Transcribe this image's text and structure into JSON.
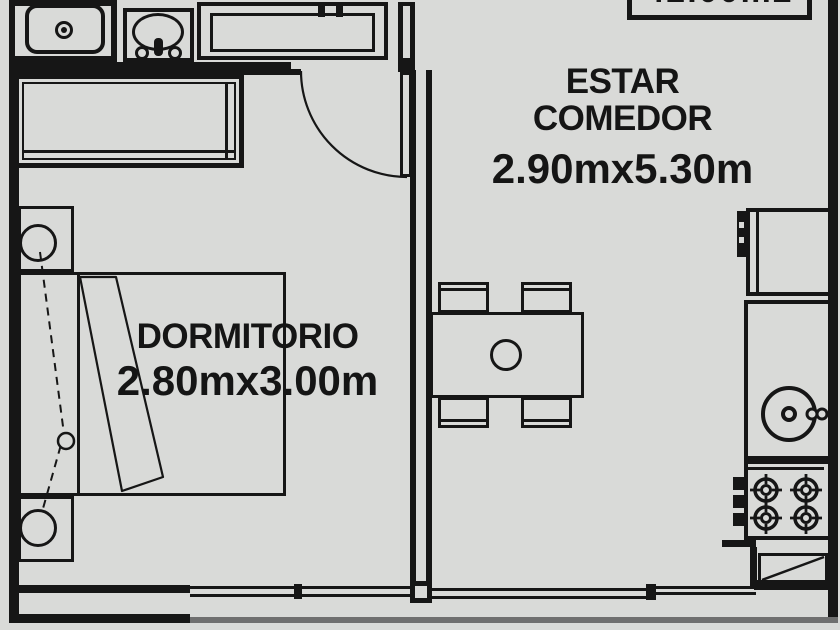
{
  "meta": {
    "type": "apartment-floor-plan",
    "bg_color": "#d9dad8",
    "line_color": "#161616",
    "window_line_color": "#6f6f6f"
  },
  "area_box": {
    "label": "42.00m2"
  },
  "rooms": {
    "living": {
      "name_line1": "ESTAR",
      "name_line2": "COMEDOR",
      "dimensions": "2.90mx5.30m"
    },
    "bedroom": {
      "name": "DORMITORIO",
      "dimensions": "2.80mx3.00m"
    }
  },
  "fixtures": [
    "kitchen-sink",
    "washbasin",
    "kitchen-counter",
    "closet",
    "bed",
    "nightstand-top",
    "nightstand-bottom",
    "wall-lamps-dashed-circuit",
    "dining-table",
    "chair-x4",
    "entry-door-swing",
    "fridge",
    "laundry-basin",
    "stove-4-burners",
    "hatched-cabinet",
    "window-bedroom",
    "window-living"
  ]
}
